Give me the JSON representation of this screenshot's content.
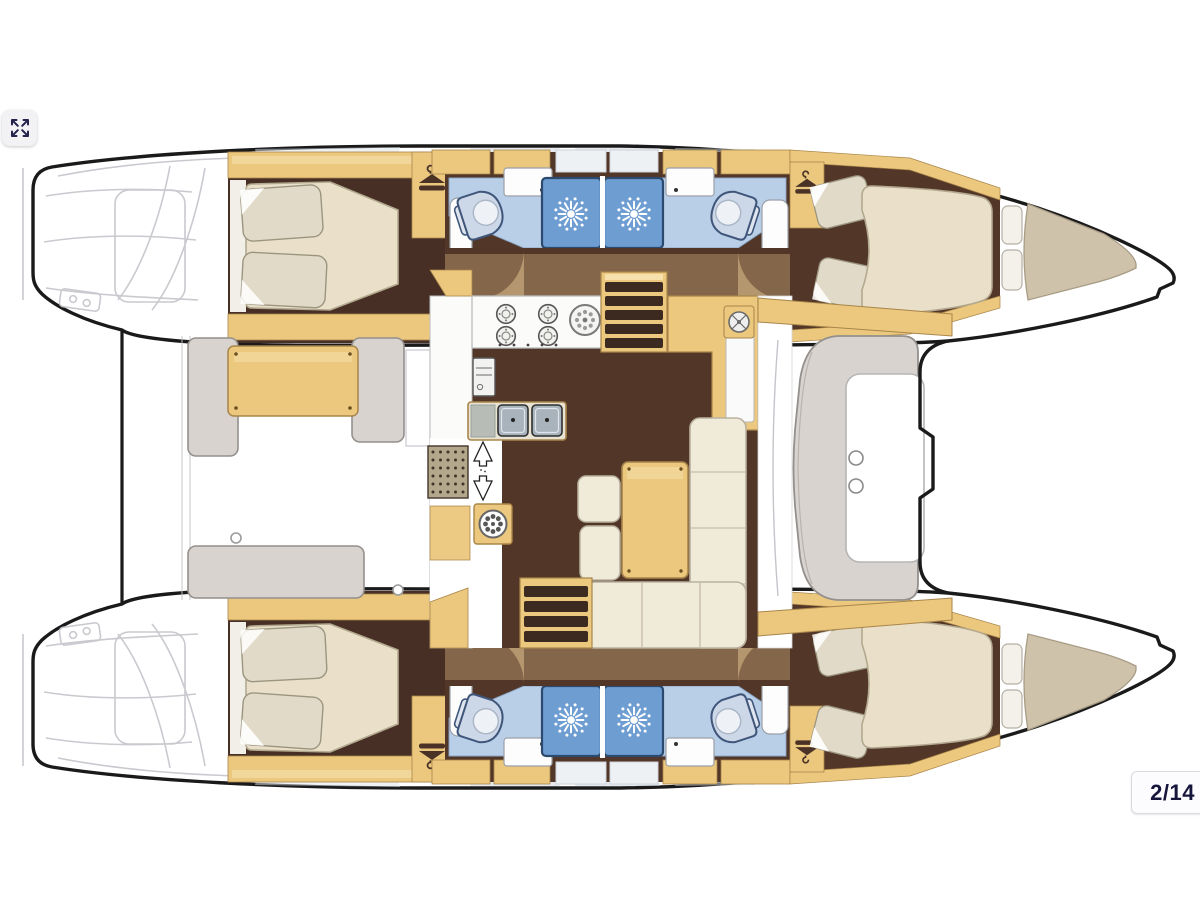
{
  "viewer": {
    "page_indicator": "2/14",
    "fullscreen_icon": "expand-arrows-icon"
  },
  "floorplan": {
    "subject": "catamaran yacht accommodation and deck plan",
    "orientation": "bows right, sterns left",
    "features": {
      "double_cabins": 4,
      "shower_compartments": 4,
      "toilets": 4,
      "saloon": "L-sofa, table, galley with stove and double sink",
      "aft_cockpit": "table with bench seating",
      "forward_cockpit": "C-bench with table",
      "trampoline": "between bows",
      "companionway_steps": 2
    }
  },
  "palette": {
    "outline": "#1a1a1a",
    "sketch": "#c4c4ca",
    "wood": "#ecc87e",
    "woodLight": "#f6e1ad",
    "woodTrim": "#a8854a",
    "floorBrown": "#523729",
    "floorBrownDark": "#472f25",
    "overlayTan": "#c2a173",
    "arcTan": "#c9ad7d",
    "bedCream": "#eae0ca",
    "bedEdge": "#b3a98f",
    "sofaCream": "#f0ead9",
    "pillow": "#e2dac8",
    "pillowEdge": "#9b957f",
    "bathBlue": "#b9cfe8",
    "bathEdge": "#8aa4c4",
    "showerBlue": "#6e9dd2",
    "showerEdge": "#2c4a6e",
    "benchGray": "#d9d3cf",
    "benchEdge": "#93908d",
    "toiletFill": "#ccd7e7",
    "toiletEdge": "#3f567a",
    "counterWhite": "#fbfbf9",
    "counterEdge": "#b9bcc0",
    "stepTread": "#3c291f",
    "wedgeTan": "#cfc2aa",
    "wedgeEdge": "#a89c86",
    "hangerBrown": "#4a3326",
    "badgeBg": "#fcfcfe",
    "badgeBorder": "#d9d9df",
    "badgeText": "#16163c",
    "buttonBg": "#f2f2f5",
    "buttonIcon": "#23234d"
  }
}
